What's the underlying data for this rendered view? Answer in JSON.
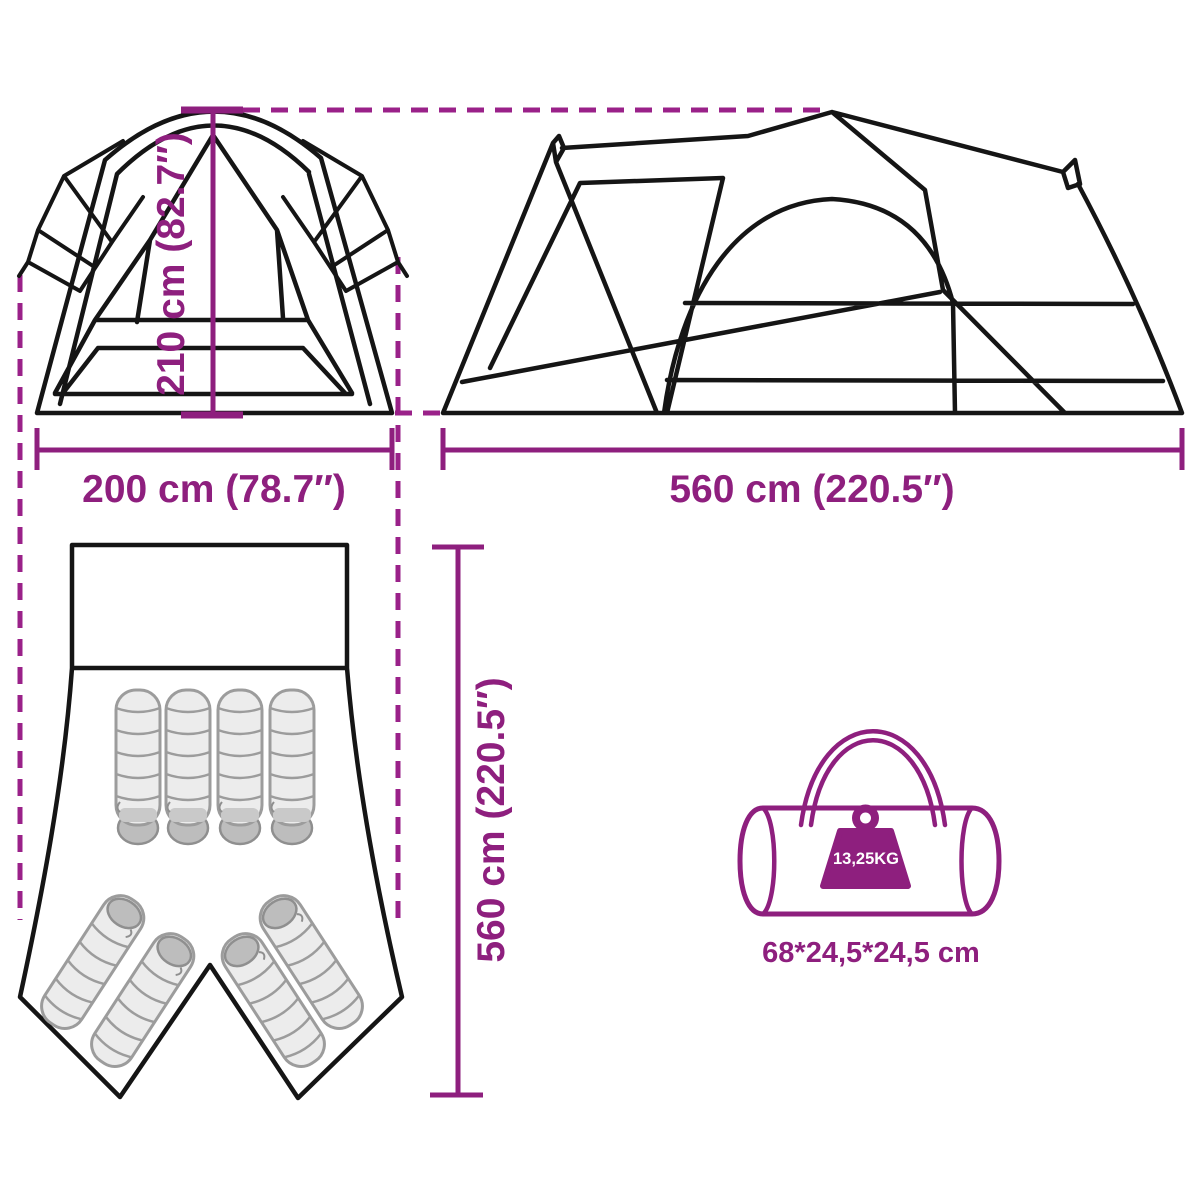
{
  "diagram": {
    "title": "tent dimensions diagram",
    "front_view": {
      "name": "tent front view",
      "height_label": "210 cm (82.7″)",
      "width_label": "200 cm (78.7″)"
    },
    "side_view": {
      "name": "tent side view",
      "length_label": "560 cm (220.5″)"
    },
    "floor_plan": {
      "name": "tent floor plan with sleeping bags",
      "depth_label": "560 cm (220.5″)",
      "sleeping_bag_count": 8
    },
    "carry_bag": {
      "name": "tent carry bag",
      "weight_label": "13,25KG",
      "dimensions_label": "68*24,5*24,5 cm"
    },
    "colors": {
      "accent": "#8E1F7E",
      "dash": "#9A2189",
      "line": "#151515",
      "bag_fill": "#ECECEC",
      "bag_shade": "#BDBDBD",
      "background": "#FFFFFF"
    }
  }
}
